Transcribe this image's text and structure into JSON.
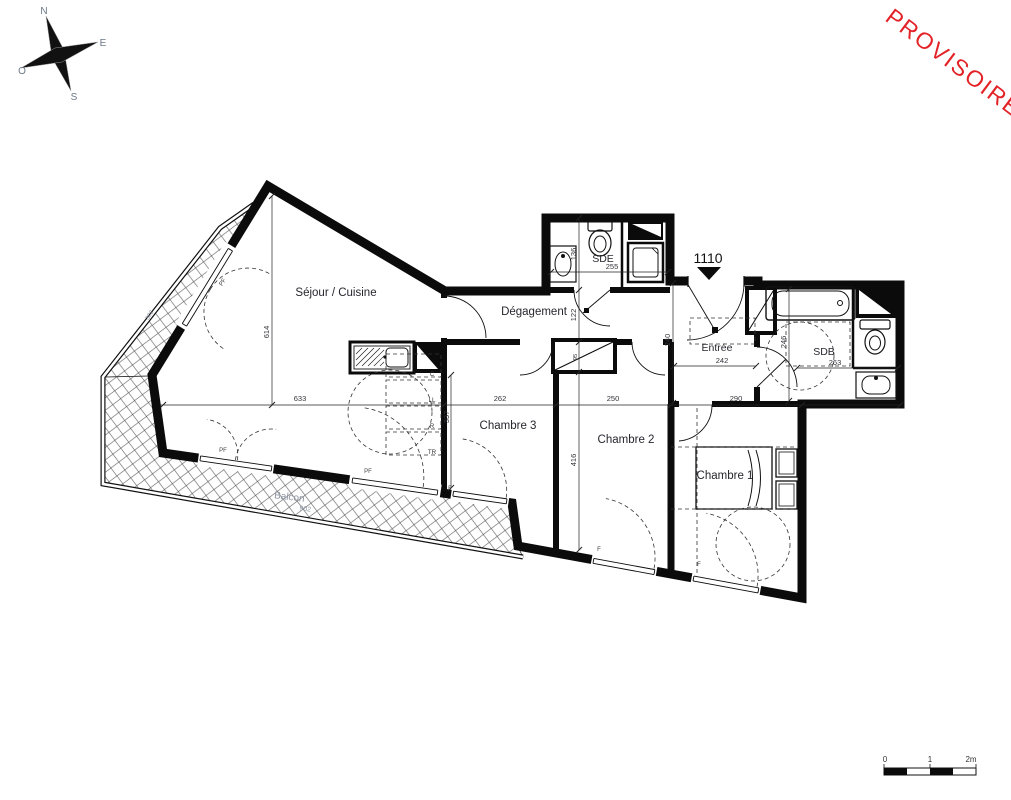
{
  "watermark": {
    "text": "PROVISOIRE",
    "color": "#e32227"
  },
  "unit": {
    "number": "1110"
  },
  "compass": {
    "n": "N",
    "e": "E",
    "s": "S",
    "o": "O"
  },
  "rooms": {
    "sejour": "Séjour / Cuisine",
    "degagement": "Dégagement",
    "chambre3": "Chambre 3",
    "chambre2": "Chambre 2",
    "chambre1": "Chambre 1",
    "entree": "Entrée",
    "sde": "SDE",
    "sdb": "SDB",
    "balcon": "Balcon"
  },
  "dimensions": {
    "sejour_height": "614",
    "sejour_width": "633",
    "chambre3_width": "262",
    "chambre2_width": "250",
    "chambre1_width": "290",
    "entree_width": "242",
    "entree_height": "240",
    "sde_width": "255",
    "sde_height": "136",
    "degagement_height": "122",
    "placard_depth": "95",
    "chambre2_height": "416",
    "chambre3_height": "337",
    "sdb_height": "246",
    "sdb_width": "263",
    "balcon_length": "902",
    "balcon_upper": "302"
  },
  "openings": {
    "pf_upper": "PF",
    "pf_sejour": "PF",
    "pf_sejour2": "PF",
    "f_chambre3": "F",
    "f_chambre2": "F",
    "f_chambre1": "F"
  },
  "appliances": {
    "c": "C",
    "ll": "LL",
    "r": "R",
    "tr": "TR"
  },
  "scale_bar": {
    "zero": "0",
    "one": "1",
    "two": "2m"
  }
}
